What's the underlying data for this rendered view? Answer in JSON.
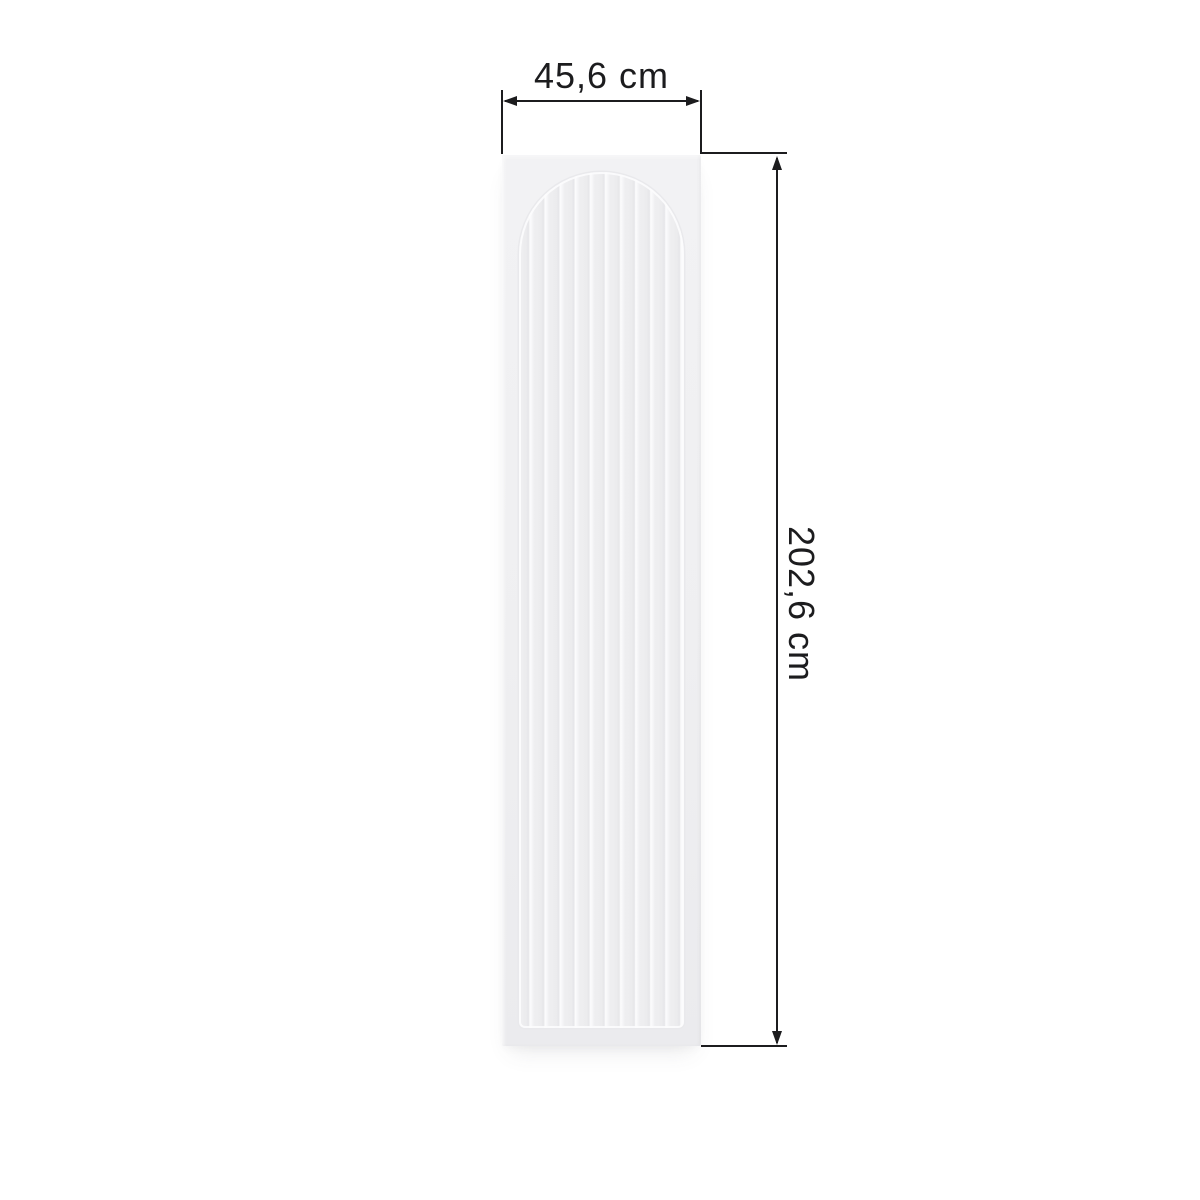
{
  "diagram": {
    "kind": "product-dimension-diagram",
    "product": "fluted-arch-wardrobe-panel",
    "dimensions": {
      "width_label": "45,6 cm",
      "height_label": "202,6 cm"
    },
    "colors": {
      "background": "#ffffff",
      "dimension_lines": "#1c1c1e",
      "panel_base": "#efeff1",
      "flute_highlight": "#fcfcfd",
      "flute_shadow": "#e6e6e9"
    }
  }
}
